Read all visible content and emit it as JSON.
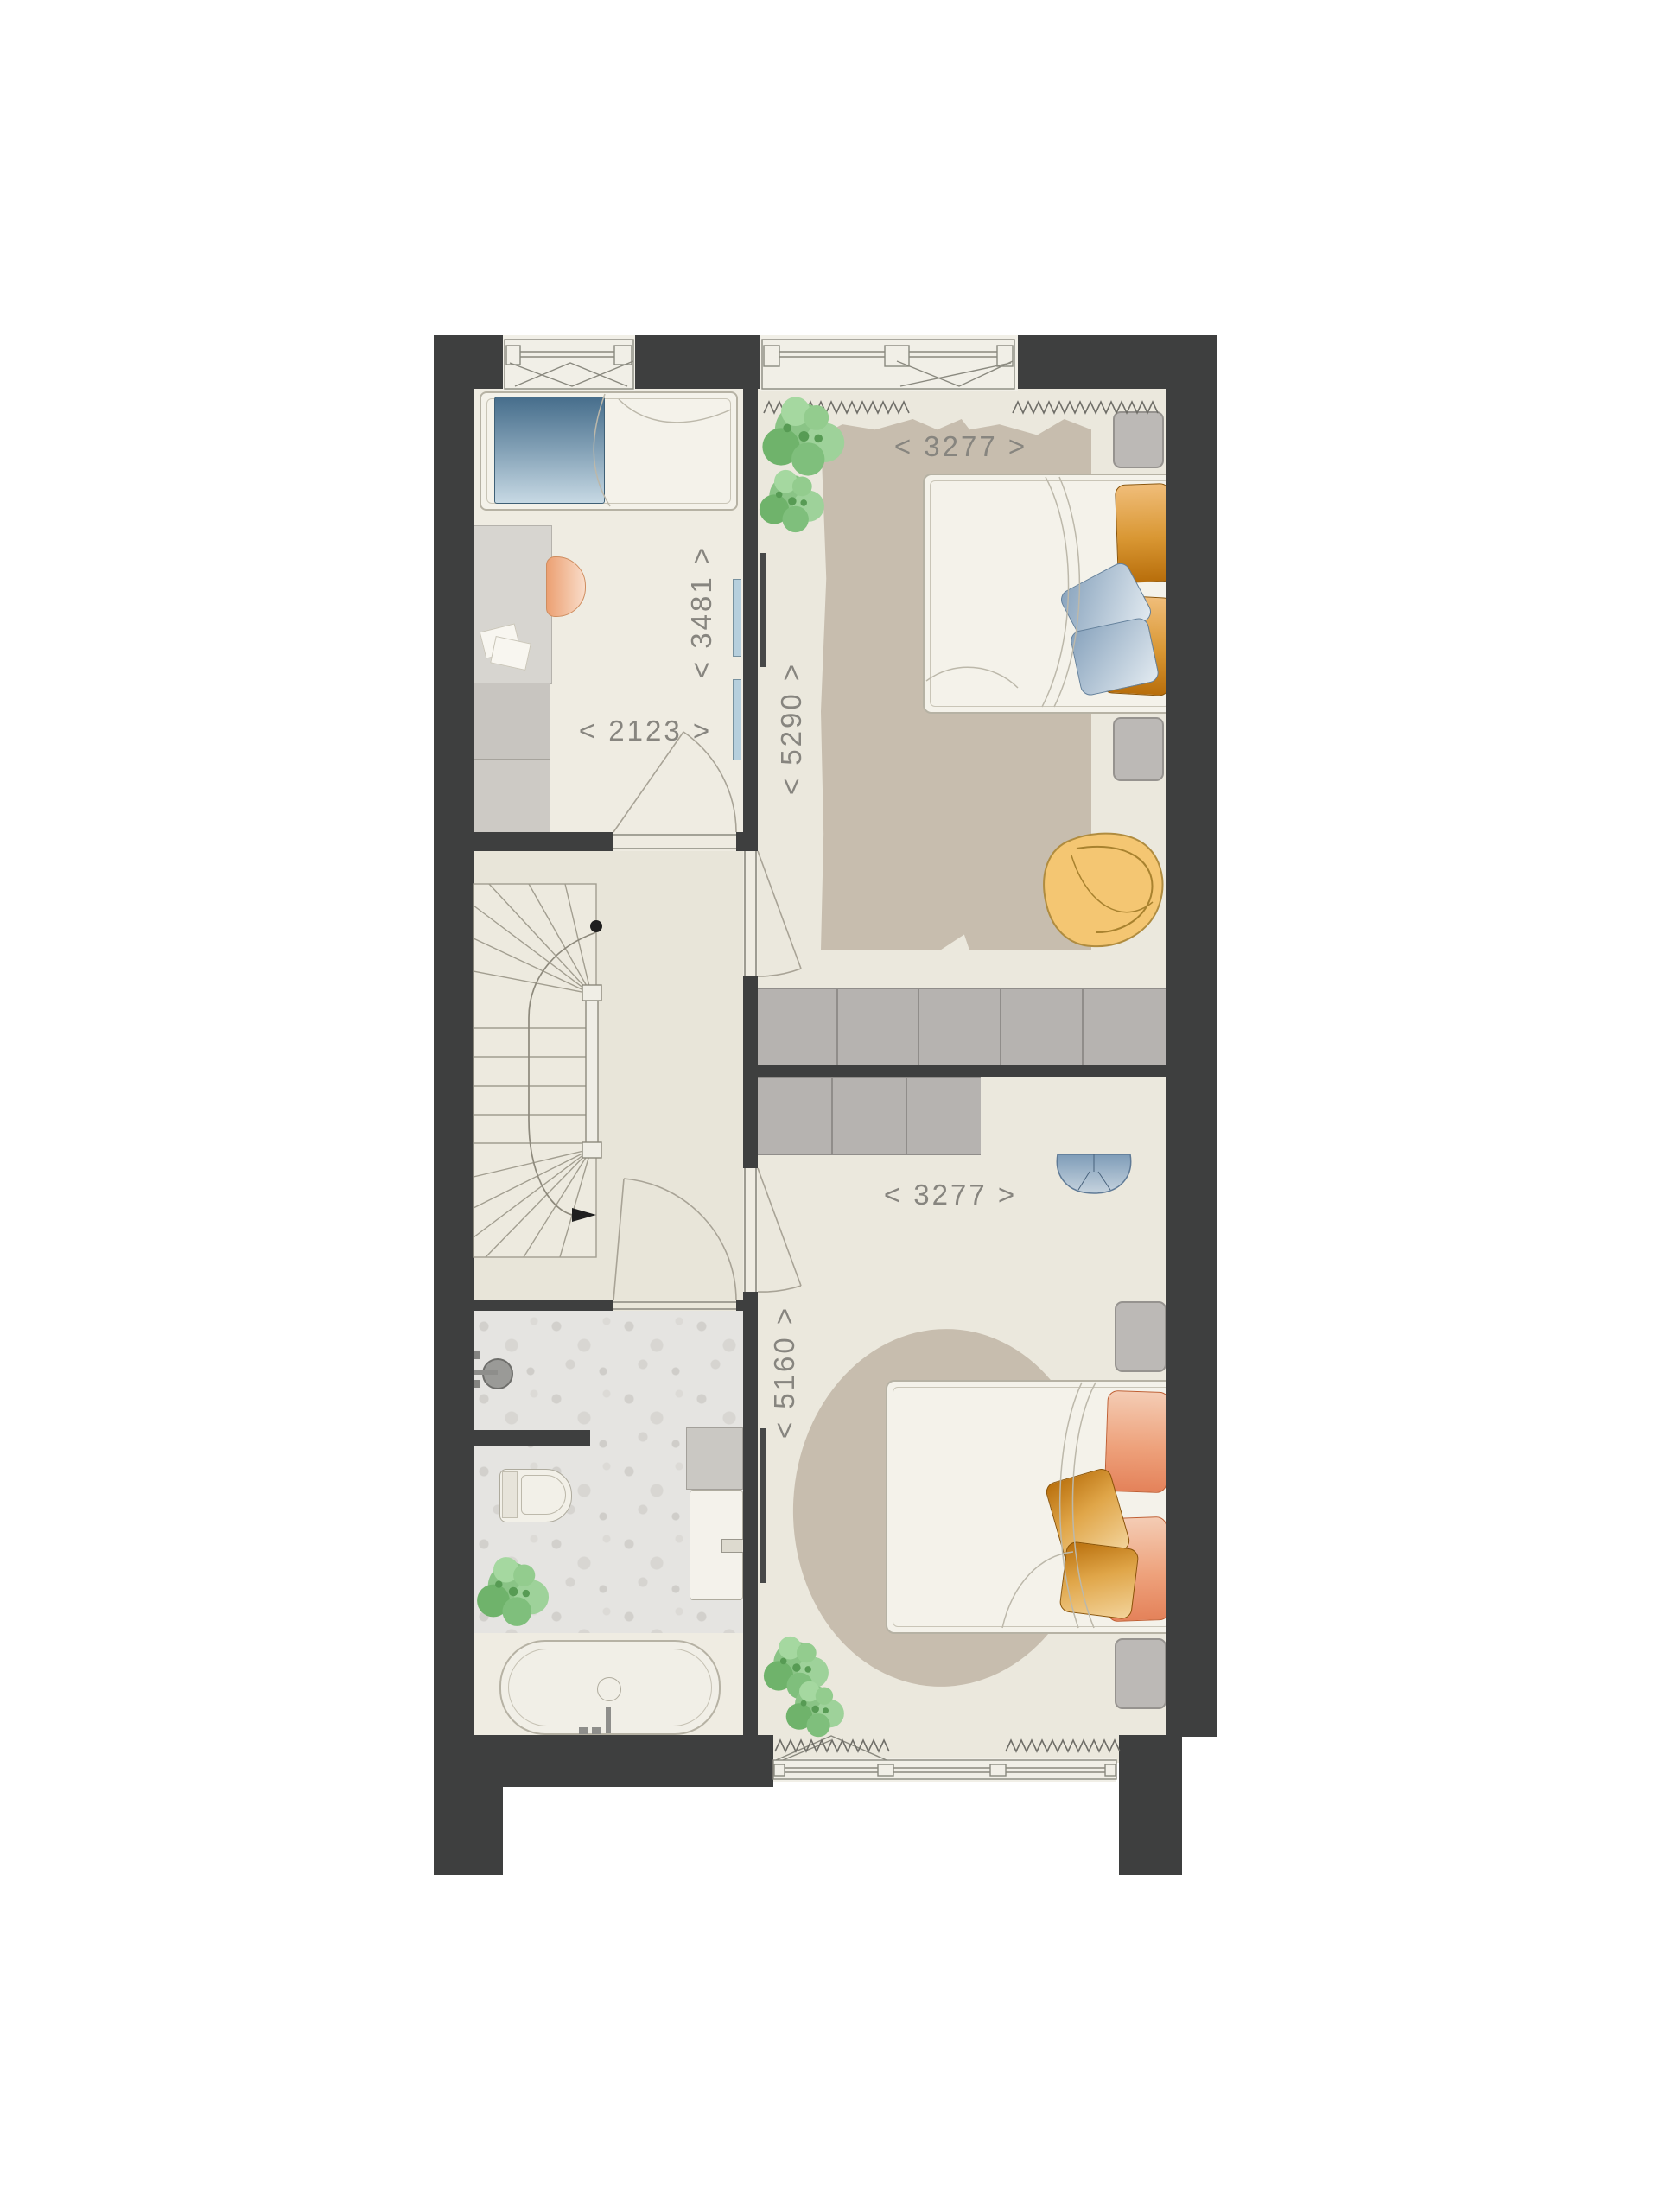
{
  "plan": {
    "type": "floor-plan-upper-storey",
    "dimension_labels": {
      "top_bedroom_width": "< 3277 >",
      "top_bedroom_depth": "< 5290 >",
      "left_room_depth": "< 3481 >",
      "left_room_width": "< 2123 >",
      "bottom_bedroom_width": "< 3277 >",
      "bottom_bedroom_depth": "< 5160 >"
    },
    "colors": {
      "wall": "#3e3f3f",
      "room_floor": "#efece2",
      "bedroom_floor": "#ebe8dd",
      "hall_floor": "#e8e5d9",
      "rug": "#c7bdae",
      "wardrobe_grey": "#b6b3b0",
      "glazing_blue": "#b6cfdd",
      "dimension_text": "#87857f",
      "chair_yellow": "#f4c672",
      "beanbag_blue": "#7e9cb8",
      "pillow_amber": "#c2770f",
      "pillow_salmon": "#e4825a",
      "pillow_blue": "#88a3bd",
      "desk_chair_peach": "#eca072",
      "plant_green": "#84c180"
    }
  }
}
